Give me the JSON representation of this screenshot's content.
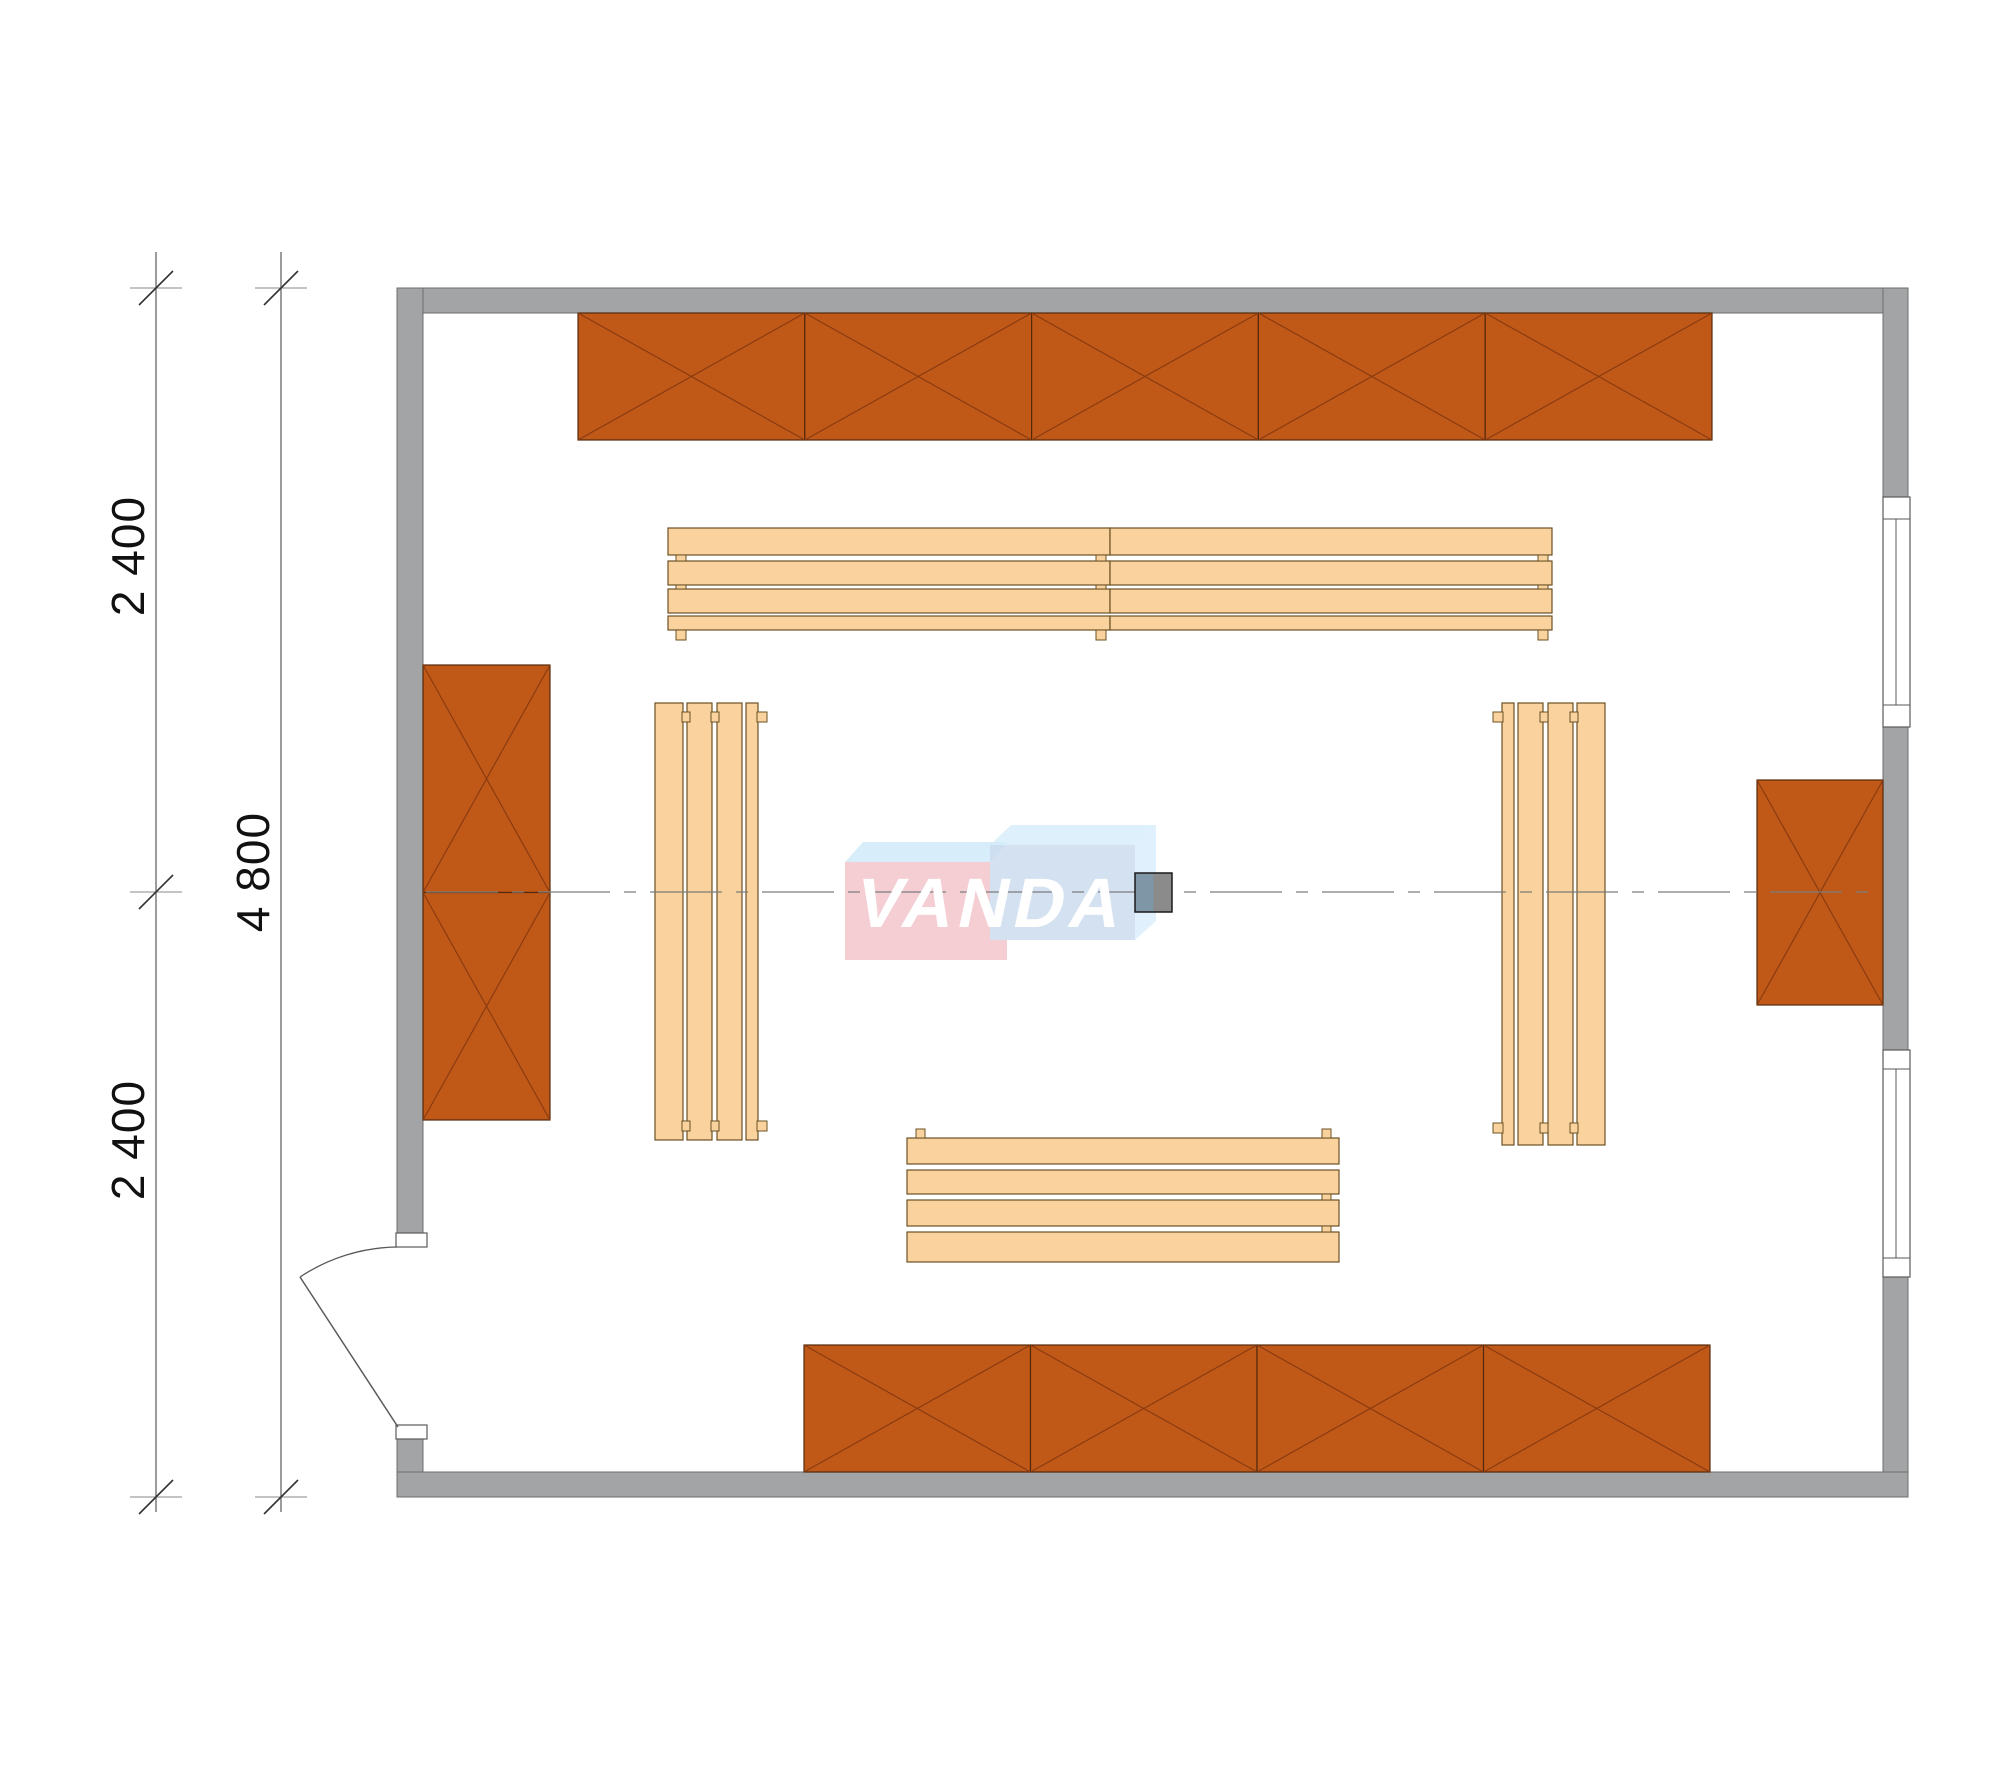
{
  "labels": {
    "dim_upper": "2 400",
    "dim_overall": "4 800",
    "dim_lower": "2 400",
    "logo": "VANDA"
  },
  "colors": {
    "background": "#ffffff",
    "wall_fill": "#a2a4a6",
    "wall_stroke": "#6e6e6e",
    "cabinet_fill": "#c05818",
    "cabinet_stroke": "#54290a",
    "cabinet_cross": "#8a3c10",
    "bench_fill": "#f9d29d",
    "bench_stroke": "#6b5124",
    "window_fill": "#ffffff",
    "window_stroke": "#5a5a5a",
    "door_stroke": "#5a5a5a",
    "dim_stroke": "#5a5a5a",
    "witness_stroke": "#888888",
    "tick_stroke": "#333333",
    "centerline_stroke": "#7d7d7d",
    "label_color": "#111111",
    "logo_text_color": "#ffffff",
    "valve_left_fill": "#7e96a6",
    "valve_right_fill": "#8b8b8b",
    "valve_stroke": "#1a1a1a"
  },
  "plan": {
    "canvas": {
      "width": 2000,
      "height": 1786
    },
    "walls": [
      {
        "name": "wall-top",
        "x": 397,
        "y": 288,
        "w": 1511,
        "h": 25
      },
      {
        "name": "wall-left-upper",
        "x": 397,
        "y": 288,
        "w": 26,
        "h": 945
      },
      {
        "name": "wall-left-lower",
        "x": 397,
        "y": 1438,
        "w": 26,
        "h": 59
      },
      {
        "name": "wall-bottom",
        "x": 397,
        "y": 1472,
        "w": 1511,
        "h": 25
      },
      {
        "name": "wall-right-upper",
        "x": 1883,
        "y": 288,
        "w": 25,
        "h": 209
      },
      {
        "name": "wall-right-middle",
        "x": 1883,
        "y": 727,
        "w": 25,
        "h": 323
      },
      {
        "name": "wall-right-lower",
        "x": 1883,
        "y": 1277,
        "w": 25,
        "h": 195
      }
    ],
    "windows": [
      {
        "name": "window-right-upper",
        "x": 1883,
        "y": 497,
        "w": 27,
        "h": 230,
        "band": 22
      },
      {
        "name": "window-right-lower",
        "x": 1883,
        "y": 1050,
        "w": 27,
        "h": 227,
        "band": 19
      }
    ],
    "door": {
      "jambs": [
        {
          "x": 396,
          "y": 1233,
          "w": 31,
          "h": 14
        },
        {
          "x": 396,
          "y": 1425,
          "w": 31,
          "h": 14
        }
      ],
      "arc": "M 397 1247 A 180 180 0 0 0 300 1277",
      "leaf": {
        "x1": 300,
        "y1": 1277,
        "x2": 398,
        "y2": 1427
      }
    },
    "cabinets": [
      {
        "name": "cabinet-top-1",
        "x": 578.0,
        "y": 313,
        "w": 226.8,
        "h": 127
      },
      {
        "name": "cabinet-top-2",
        "x": 804.8,
        "y": 313,
        "w": 226.8,
        "h": 127
      },
      {
        "name": "cabinet-top-3",
        "x": 1031.6,
        "y": 313,
        "w": 226.8,
        "h": 127
      },
      {
        "name": "cabinet-top-4",
        "x": 1258.4,
        "y": 313,
        "w": 226.8,
        "h": 127
      },
      {
        "name": "cabinet-top-5",
        "x": 1485.2,
        "y": 313,
        "w": 226.8,
        "h": 127
      },
      {
        "name": "cabinet-bottom-1",
        "x": 804,
        "y": 1345,
        "w": 226.5,
        "h": 127
      },
      {
        "name": "cabinet-bottom-2",
        "x": 1030.5,
        "y": 1345,
        "w": 226.5,
        "h": 127
      },
      {
        "name": "cabinet-bottom-3",
        "x": 1257,
        "y": 1345,
        "w": 226.5,
        "h": 127
      },
      {
        "name": "cabinet-bottom-4",
        "x": 1483.5,
        "y": 1345,
        "w": 226.5,
        "h": 127
      },
      {
        "name": "cabinet-left-1",
        "x": 423,
        "y": 665,
        "w": 127,
        "h": 227.5
      },
      {
        "name": "cabinet-left-2",
        "x": 423,
        "y": 892.5,
        "w": 127,
        "h": 227.5
      },
      {
        "name": "cabinet-right-1",
        "x": 1757,
        "y": 780,
        "w": 126,
        "h": 225
      }
    ],
    "benches": [
      {
        "name": "bench-top-left",
        "planks": [
          [
            668,
            528,
            442,
            27
          ],
          [
            668,
            561,
            442,
            24
          ],
          [
            668,
            589,
            442,
            24
          ],
          [
            668,
            616,
            442,
            14
          ]
        ],
        "nubs": [
          [
            676,
            555,
            10,
            6
          ],
          [
            676,
            585,
            10,
            4
          ],
          [
            676,
            630,
            10,
            10
          ],
          [
            1096,
            555,
            10,
            6
          ],
          [
            1096,
            585,
            10,
            4
          ],
          [
            1096,
            630,
            10,
            10
          ]
        ]
      },
      {
        "name": "bench-top-right",
        "planks": [
          [
            1110,
            528,
            442,
            27
          ],
          [
            1110,
            561,
            442,
            24
          ],
          [
            1110,
            589,
            442,
            24
          ],
          [
            1110,
            616,
            442,
            14
          ]
        ],
        "nubs": [
          [
            1538,
            555,
            10,
            6
          ],
          [
            1538,
            585,
            10,
            4
          ],
          [
            1538,
            630,
            10,
            10
          ]
        ]
      },
      {
        "name": "bench-left",
        "planks": [
          [
            655,
            703,
            28,
            437
          ],
          [
            687,
            703,
            25,
            437
          ],
          [
            717,
            703,
            25,
            437
          ],
          [
            746,
            703,
            12,
            437
          ]
        ],
        "nubs": [
          [
            682,
            712,
            8,
            10
          ],
          [
            711,
            712,
            8,
            10
          ],
          [
            757,
            712,
            10,
            10
          ],
          [
            682,
            1121,
            8,
            10
          ],
          [
            711,
            1121,
            8,
            10
          ],
          [
            757,
            1121,
            10,
            10
          ]
        ]
      },
      {
        "name": "bench-right",
        "planks": [
          [
            1502,
            703,
            12,
            442
          ],
          [
            1518,
            703,
            25,
            442
          ],
          [
            1548,
            703,
            25,
            442
          ],
          [
            1577,
            703,
            28,
            442
          ]
        ],
        "nubs": [
          [
            1493,
            712,
            10,
            10
          ],
          [
            1540,
            712,
            8,
            10
          ],
          [
            1570,
            712,
            8,
            10
          ],
          [
            1493,
            1123,
            10,
            10
          ],
          [
            1540,
            1123,
            8,
            10
          ],
          [
            1570,
            1123,
            8,
            10
          ]
        ]
      },
      {
        "name": "bench-bottom",
        "planks": [
          [
            907,
            1138,
            432,
            26
          ],
          [
            907,
            1170,
            432,
            24
          ],
          [
            907,
            1200,
            432,
            26
          ],
          [
            907,
            1232,
            432,
            30
          ]
        ],
        "nubs": [
          [
            916,
            1129,
            9,
            9
          ],
          [
            1322,
            1129,
            9,
            9
          ],
          [
            1322,
            1194,
            9,
            6
          ],
          [
            1322,
            1226,
            9,
            6
          ]
        ]
      }
    ],
    "dimension_lines": {
      "lines": [
        {
          "x": 156,
          "y1": 252,
          "y2": 1512
        },
        {
          "x": 281,
          "y1": 252,
          "y2": 1512
        }
      ],
      "ticks": [
        {
          "x": 156,
          "y": 288
        },
        {
          "x": 156,
          "y": 892
        },
        {
          "x": 156,
          "y": 1497
        },
        {
          "x": 281,
          "y": 288
        },
        {
          "x": 281,
          "y": 1497
        }
      ]
    },
    "centerline": {
      "x1": 426,
      "y1": 892,
      "x2": 1881,
      "y2": 892
    },
    "logo_blocks": [
      {
        "type": "polygon",
        "name": "logo-pink-top-face",
        "points": "845,862 863,842 1008,842 990,862",
        "fill": "rgba(198,229,247,0.70)"
      },
      {
        "type": "rect",
        "name": "logo-red-block",
        "x": 845,
        "y": 862,
        "w": 145,
        "h": 98,
        "fill": "rgba(242,194,201,0.80)"
      },
      {
        "type": "rect",
        "name": "logo-red-block-notch",
        "x": 990,
        "y": 940,
        "w": 17,
        "h": 20,
        "fill": "rgba(242,194,201,0.80)"
      },
      {
        "type": "polygon",
        "name": "logo-blue-top-face",
        "points": "990,845 1011,825 1156,825 1135,845",
        "fill": "rgba(213,236,250,0.80)"
      },
      {
        "type": "polygon",
        "name": "logo-blue-side-face",
        "points": "1135,845 1156,825 1156,921 1135,940",
        "fill": "rgba(216,238,252,0.80)"
      },
      {
        "type": "rect",
        "name": "logo-blue-block",
        "x": 990,
        "y": 845,
        "w": 145,
        "h": 95,
        "fill": "rgba(202,219,238,0.82)"
      }
    ],
    "valve": {
      "x": 1135,
      "y": 873,
      "w": 37,
      "h": 39
    }
  }
}
